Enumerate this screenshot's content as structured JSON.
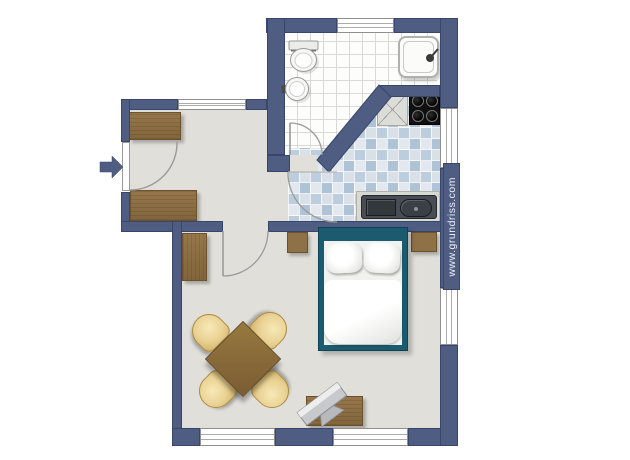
{
  "watermark": {
    "text": "www.grundriss.com"
  },
  "entrance": {
    "symbol": "right-arrow"
  },
  "rooms": [
    {
      "name": "bathroom"
    },
    {
      "name": "kitchen"
    },
    {
      "name": "hallway"
    },
    {
      "name": "living-sleeping-area"
    }
  ],
  "fixtures": [
    "toilet",
    "wash-basin",
    "shower",
    "stove-4-burners",
    "worktop-x-cabinet",
    "kitchen-counter-double-sink",
    "wardrobe",
    "sideboard",
    "tall-cabinet",
    "double-bed-with-pillows-and-duvet",
    "nightstand-left",
    "nightstand-right",
    "dining-table",
    "chair-nw",
    "chair-ne",
    "chair-sw",
    "chair-se",
    "tv-bench",
    "tv",
    "entrance-arrow"
  ],
  "palette": {
    "wall": "#4f5d82",
    "wall_outline": "#39466b",
    "floor": "#e0dfda",
    "bathroom_tile": "#fdfdfc",
    "kitchen_tile_dark": "#afc3d6",
    "kitchen_tile_light": "#d9e0e8",
    "wood": "#96774b",
    "chair": "#e9d193",
    "bed_frame": "#1a5b70",
    "stove": "#101010",
    "sink": "#474d53"
  }
}
